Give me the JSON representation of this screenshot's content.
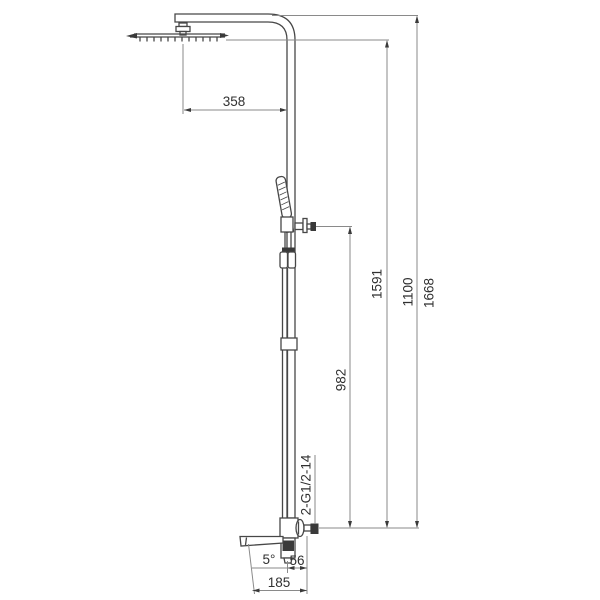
{
  "dims": {
    "arm_reach": "358",
    "hand_shower_height": "982",
    "head_height": "1591",
    "riser_height": "1100",
    "total_height": "1668",
    "inlet_thread": "2-G1/2-14",
    "spout_angle": "5°",
    "outlet_offset": "56",
    "spout_reach": "185"
  },
  "colors": {
    "background": "#ffffff",
    "fixture_line": "#474747",
    "dimension_line": "#8a8a8a",
    "text": "#303030",
    "dark_fill": "#3a3a3a"
  }
}
